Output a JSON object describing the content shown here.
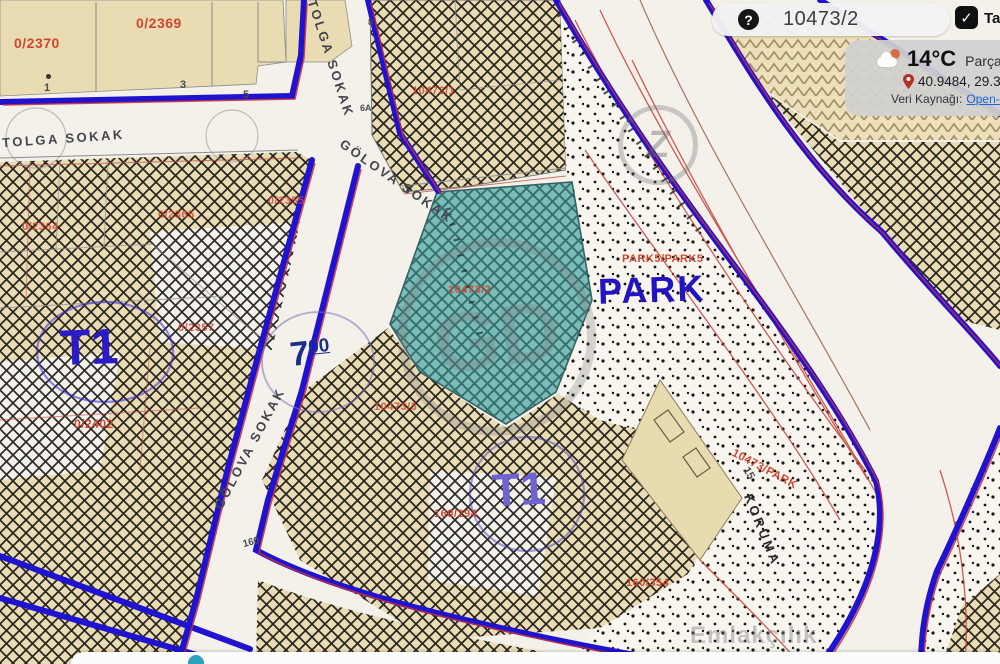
{
  "colors": {
    "road_edge_blue": "#1f13cf",
    "companion_red": "#c22f3e",
    "parcel_beige": "#e9dcb4",
    "teal_parcel": "#65b3ae",
    "parcel_label_red": "#cf4631",
    "zone_blue": "#2b1ac7",
    "link_blue": "#1a66cc"
  },
  "top_bar": {
    "parcel_pill": {
      "icon": "?",
      "value": "10473/2"
    },
    "fullscreen": {
      "check": "✓",
      "label": "Ta"
    }
  },
  "weather": {
    "icon": "partly-cloudy",
    "temperature": "14°C",
    "condition": "Parçalı",
    "coordinates": "40.9484, 29.359",
    "source_label": "Veri Kaynağı:",
    "source_link": "Open-Me"
  },
  "map": {
    "streets": [
      {
        "text": "TOLGA SOKAK"
      },
      {
        "text": "TOLGA SOKAK"
      },
      {
        "text": "GÖLOVA SOKAK"
      },
      {
        "text": "GÖLOVA SOKAK"
      }
    ],
    "zones": {
      "t1_left": "T1",
      "t1_bottom": "T1",
      "park": "PARK",
      "width_main": "7",
      "width_sup": "00"
    },
    "parcels": {
      "p2370": "0/2370",
      "p2369": "0/2369",
      "p2355": "0/2355",
      "p2364": "0/2364",
      "p2365": "0/2365",
      "p2357": "0/2357",
      "p2402": "0/2402",
      "p10473_1": "10473/1",
      "p10473_2": "10473/2",
      "p10473_3": "10473/3",
      "p160_294": "160/294",
      "p160_354": "160/354",
      "p10473_park": "10473/PARK",
      "park5": "PARK5/PARK5"
    },
    "houses": {
      "n1": "1",
      "n3": "3",
      "n5": "5",
      "n8": "8",
      "n6a": "6A",
      "n160": "160",
      "n15": "15"
    },
    "other": {
      "koruma": "KORUMA"
    },
    "watermarks": {
      "ring_letters": "GD",
      "small_logo": "Z",
      "bottom_text": "Emlakçılık",
      "corner_text": "56A /ER56"
    }
  }
}
